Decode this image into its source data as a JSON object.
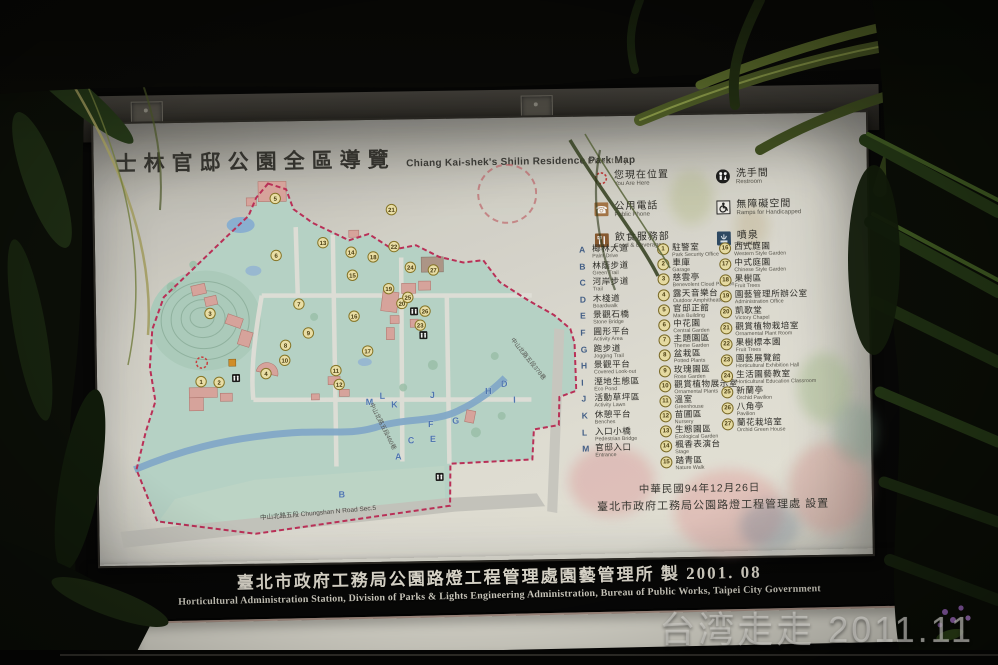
{
  "colors": {
    "board_bg": "#e7e5db",
    "park_fill": "#bcdacd",
    "water": "#86aed0",
    "building": "#dfa9a2",
    "boundary": "#c0305a",
    "marker_fill": "#efe3a8",
    "marker_ring": "#7d6c26",
    "letter_blue": "#44618c",
    "rail_dark": "#23201b",
    "footer_text": "#d8d4c8"
  },
  "board": {
    "title_zh": "士林官邸公園全區導覽",
    "title_en": "Chiang Kai-shek's Shilin Residence Park Map",
    "directory_label": "Directory",
    "legend": [
      {
        "icon": "you-are-here",
        "zh": "您現在位置",
        "en": "You Are Here"
      },
      {
        "icon": "public-phone",
        "zh": "公用電話",
        "en": "Public Phone"
      },
      {
        "icon": "food",
        "zh": "飲食服務部",
        "en": "Food & Beverages"
      },
      {
        "icon": "restroom",
        "zh": "洗手間",
        "en": "Restroom"
      },
      {
        "icon": "ramp",
        "zh": "無障礙空間",
        "en": "Ramps for Handicapped"
      },
      {
        "icon": "fountain",
        "zh": "噴泉",
        "en": "Fountain"
      }
    ],
    "letter_items": [
      {
        "key": "A",
        "zh": "椰林大道",
        "en": "Palm Drive"
      },
      {
        "key": "B",
        "zh": "林蔭步道",
        "en": "Green Trail"
      },
      {
        "key": "C",
        "zh": "河岸步道",
        "en": "Trail"
      },
      {
        "key": "D",
        "zh": "木棧道",
        "en": "Boardwalk"
      },
      {
        "key": "E",
        "zh": "景觀石橋",
        "en": "Stone Bridge"
      },
      {
        "key": "F",
        "zh": "圓形平台",
        "en": "Activity Area"
      },
      {
        "key": "G",
        "zh": "跑步道",
        "en": "Jogging Trail"
      },
      {
        "key": "H",
        "zh": "景觀平台",
        "en": "Covered Look-out"
      },
      {
        "key": "I",
        "zh": "溼地生態區",
        "en": "Eco Pond"
      },
      {
        "key": "J",
        "zh": "活動草坪區",
        "en": "Activity Lawn"
      },
      {
        "key": "K",
        "zh": "休憩平台",
        "en": "Benches"
      },
      {
        "key": "L",
        "zh": "入口小橋",
        "en": "Pedestrian Bridge"
      },
      {
        "key": "M",
        "zh": "官邸入口",
        "en": "Entrance"
      }
    ],
    "number_items_1": [
      {
        "key": "1",
        "zh": "駐警室",
        "en": "Park Security Office"
      },
      {
        "key": "2",
        "zh": "車庫",
        "en": "Garage"
      },
      {
        "key": "3",
        "zh": "慈雲亭",
        "en": "Benevolent Cloud Pavilion"
      },
      {
        "key": "4",
        "zh": "露天音樂台",
        "en": "Outdoor Amphitheater"
      },
      {
        "key": "5",
        "zh": "官邸正館",
        "en": "Main Building"
      },
      {
        "key": "6",
        "zh": "中花園",
        "en": "Central Garden"
      },
      {
        "key": "7",
        "zh": "主題園區",
        "en": "Theme Garden"
      },
      {
        "key": "8",
        "zh": "盆栽區",
        "en": "Potted Plants"
      },
      {
        "key": "9",
        "zh": "玫瑰園區",
        "en": "Rose Garden"
      },
      {
        "key": "10",
        "zh": "觀賞植物展示室",
        "en": "Ornamental Plants"
      },
      {
        "key": "11",
        "zh": "溫室",
        "en": "Greenhouse"
      },
      {
        "key": "12",
        "zh": "苗圃區",
        "en": "Nursery"
      },
      {
        "key": "13",
        "zh": "生態園區",
        "en": "Ecological Garden"
      },
      {
        "key": "14",
        "zh": "楓香表演台",
        "en": "Stage"
      },
      {
        "key": "15",
        "zh": "踏青區",
        "en": "Nature Walk"
      }
    ],
    "number_items_2": [
      {
        "key": "16",
        "zh": "西式庭園",
        "en": "Western Style Garden"
      },
      {
        "key": "17",
        "zh": "中式庭園",
        "en": "Chinese Style Garden"
      },
      {
        "key": "18",
        "zh": "果樹區",
        "en": "Fruit Trees"
      },
      {
        "key": "19",
        "zh": "園藝管理所辦公室",
        "en": "Administration Office"
      },
      {
        "key": "20",
        "zh": "凱歌堂",
        "en": "Victory Chapel"
      },
      {
        "key": "21",
        "zh": "觀賞植物栽培室",
        "en": "Ornamental Plant Room"
      },
      {
        "key": "22",
        "zh": "果樹標本園",
        "en": "Fruit Trees"
      },
      {
        "key": "23",
        "zh": "園藝展覽館",
        "en": "Horticultural Exhibition Hall"
      },
      {
        "key": "24",
        "zh": "生活園藝教室",
        "en": "Horticultural Education Classroom"
      },
      {
        "key": "25",
        "zh": "新蘭亭",
        "en": "Orchid Pavilion"
      },
      {
        "key": "26",
        "zh": "八角亭",
        "en": "Pavilion"
      },
      {
        "key": "27",
        "zh": "蘭花栽培室",
        "en": "Orchid Green House"
      }
    ],
    "date_line": "中華民國94年12月26日",
    "installed_line": "臺北市政府工務局公園路燈工程管理處  設置",
    "map": {
      "roads": {
        "main_zh": "中山北路五段",
        "main_en": "Chungshan N Road Sec.5",
        "lane460": "中山北路五段460巷",
        "lane378": "中山北路五段378巷"
      },
      "markers": [
        {
          "n": "1",
          "x": 98,
          "y": 213
        },
        {
          "n": "2",
          "x": 116,
          "y": 214
        },
        {
          "n": "3",
          "x": 108,
          "y": 145
        },
        {
          "n": "4",
          "x": 163,
          "y": 206
        },
        {
          "n": "5",
          "x": 175,
          "y": 31
        },
        {
          "n": "6",
          "x": 175,
          "y": 88
        },
        {
          "n": "7",
          "x": 197,
          "y": 137
        },
        {
          "n": "8",
          "x": 183,
          "y": 178
        },
        {
          "n": "9",
          "x": 206,
          "y": 166
        },
        {
          "n": "10",
          "x": 182,
          "y": 193
        },
        {
          "n": "11",
          "x": 233,
          "y": 204
        },
        {
          "n": "12",
          "x": 236,
          "y": 218
        },
        {
          "n": "13",
          "x": 222,
          "y": 76
        },
        {
          "n": "14",
          "x": 250,
          "y": 86
        },
        {
          "n": "15",
          "x": 251,
          "y": 109
        },
        {
          "n": "16",
          "x": 252,
          "y": 150
        },
        {
          "n": "17",
          "x": 265,
          "y": 185
        },
        {
          "n": "18",
          "x": 272,
          "y": 91
        },
        {
          "n": "19",
          "x": 287,
          "y": 123
        },
        {
          "n": "20",
          "x": 300,
          "y": 138
        },
        {
          "n": "21",
          "x": 291,
          "y": 44
        },
        {
          "n": "22",
          "x": 293,
          "y": 81
        },
        {
          "n": "23",
          "x": 318,
          "y": 160
        },
        {
          "n": "24",
          "x": 309,
          "y": 102
        },
        {
          "n": "25",
          "x": 306,
          "y": 132
        },
        {
          "n": "26",
          "x": 323,
          "y": 146
        },
        {
          "n": "27",
          "x": 332,
          "y": 105
        }
      ],
      "map_letters": [
        {
          "ch": "A",
          "x": 294,
          "y": 294
        },
        {
          "ch": "B",
          "x": 237,
          "y": 331
        },
        {
          "ch": "C",
          "x": 307,
          "y": 278
        },
        {
          "ch": "D",
          "x": 401,
          "y": 223
        },
        {
          "ch": "E",
          "x": 329,
          "y": 277
        },
        {
          "ch": "F",
          "x": 327,
          "y": 262
        },
        {
          "ch": "G",
          "x": 352,
          "y": 259
        },
        {
          "ch": "H",
          "x": 385,
          "y": 230
        },
        {
          "ch": "I",
          "x": 411,
          "y": 239
        },
        {
          "ch": "J",
          "x": 329,
          "y": 233
        },
        {
          "ch": "K",
          "x": 291,
          "y": 242
        },
        {
          "ch": "L",
          "x": 279,
          "y": 233
        },
        {
          "ch": "M",
          "x": 266,
          "y": 239
        }
      ],
      "restrooms": [
        {
          "x": 133,
          "y": 210
        },
        {
          "x": 312,
          "y": 146
        },
        {
          "x": 321,
          "y": 170
        },
        {
          "x": 335,
          "y": 312
        }
      ],
      "you_are_here": {
        "x": 99,
        "y": 194
      }
    }
  },
  "footer_bar": {
    "line_zh": "臺北市政府工務局公園路燈工程管理處園藝管理所 製  2001. 08",
    "line_en": "Horticultural  Administration  Station,  Division  of  Parks  &  Lights  Engineering  Administration,  Bureau  of  Public  Works,  Taipei  City  Government"
  },
  "photo": {
    "watermark": "台湾走走 2011.11"
  }
}
